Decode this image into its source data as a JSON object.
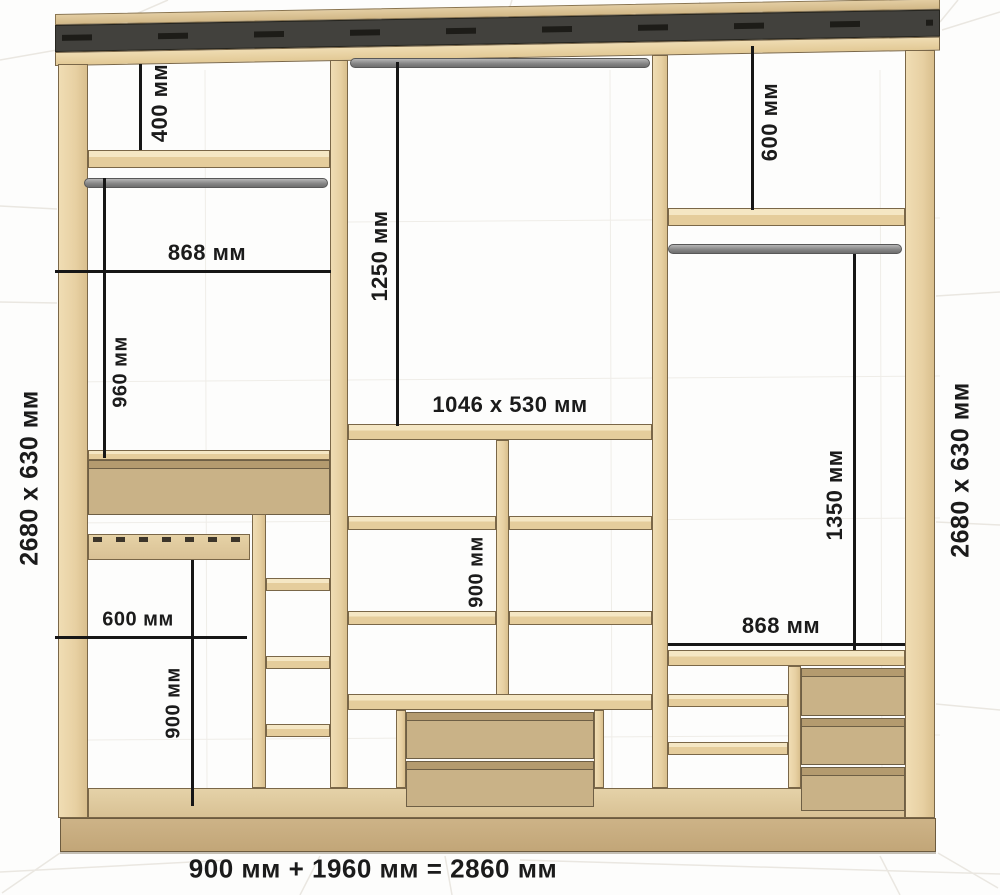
{
  "diagram": {
    "type": "wardrobe-interior-dimension-drawing",
    "total_width": "900 мм + 1960 мм = 2860 мм",
    "side_left": "2680 x 630 мм",
    "side_right": "2680 x 630 мм",
    "left_section": {
      "top_gap": "400 мм",
      "width": "868 мм",
      "hanging_height": "960 мм",
      "lower_width": "600 мм",
      "lower_height": "900 мм"
    },
    "middle_section": {
      "hanging_height": "1250 мм",
      "panel_size": "1046 x 530 мм",
      "compartment_height": "900 мм"
    },
    "right_section": {
      "top_gap": "600 мм",
      "hanging_height": "1350 мм",
      "width": "868 мм"
    },
    "colors": {
      "wood": "#e7d0a2",
      "wood_light": "#f0ddb4",
      "drawer_face": "#c9b287",
      "plinth": "#c8ae82",
      "cornice": "#42413d",
      "rod": "#8f8f8f",
      "dimension": "#161616",
      "background": "#fdfdfc"
    }
  }
}
